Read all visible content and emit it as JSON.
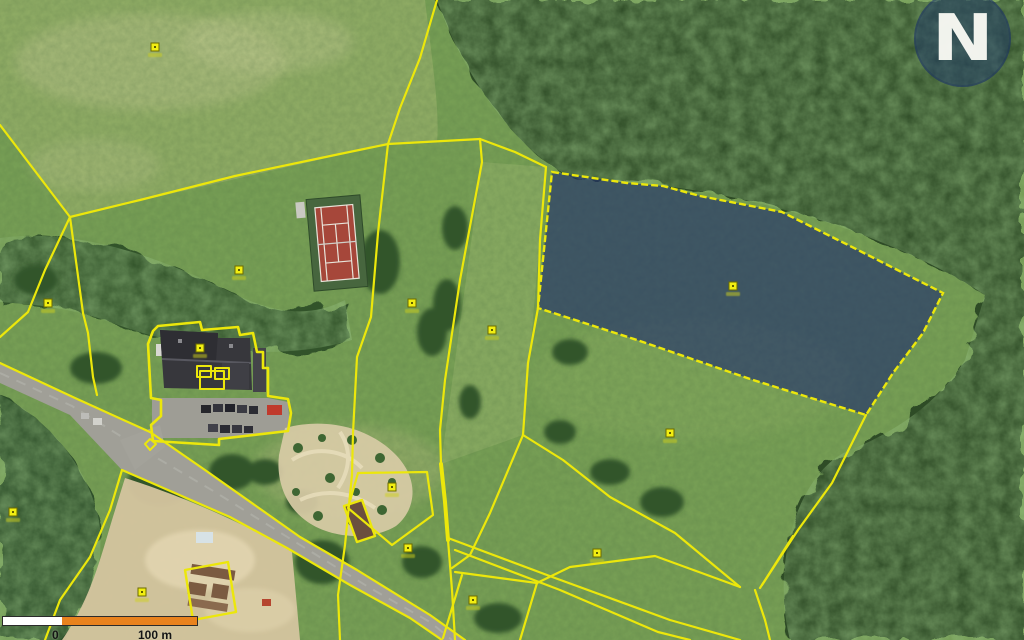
{
  "app": {
    "name": "cadastre-aerial-map-view",
    "logo_letter": "N"
  },
  "scalebar": {
    "label_zero": "0",
    "label_end": "100 m",
    "segment1_color": "#ffffff",
    "segment2_color": "#e8821e"
  },
  "map": {
    "boundary_color": "#ece70b",
    "selected_parcel": {
      "fill": "#18256e",
      "fill_opacity": 0.58,
      "outline_dash": "7 3",
      "points": "552,172 627,183 663,186 700,196 782,212 850,246 943,293 923,333 893,373 866,415 753,380 637,340 538,308 545,240"
    },
    "boundaries": [
      {
        "points": "0,125 70,217"
      },
      {
        "points": "70,217 140,200 235,176 335,155 388,144"
      },
      {
        "points": "437,0 420,58 400,108 388,144"
      },
      {
        "points": "388,144 480,139"
      },
      {
        "points": "480,139 515,152 546,167"
      },
      {
        "points": "388,144 378,233 371,317 357,357 353,433 352,475"
      },
      {
        "points": "352,475 345,545 338,595 340,640"
      },
      {
        "points": "480,139 482,162 460,280 445,380 440,430 441,464"
      },
      {
        "points": "441,464 445,502 448,540",
        "w": 4
      },
      {
        "points": "546,167 540,240 538,308 528,363 523,435"
      },
      {
        "points": "523,435 490,513 470,555 452,568"
      },
      {
        "points": "523,435 563,460 610,497 675,533 740,587"
      },
      {
        "points": "866,415 832,483 798,530 760,588"
      },
      {
        "points": "793,536 762,585"
      },
      {
        "points": "755,590 765,620 770,640"
      },
      {
        "points": "740,587 655,556 570,567 537,583"
      },
      {
        "points": "448,538 555,578 670,620 740,640"
      },
      {
        "points": "455,550 560,590 658,632 690,640"
      },
      {
        "points": "448,540 452,590 455,640"
      },
      {
        "points": "455,572 537,583"
      },
      {
        "points": "537,583 520,640"
      },
      {
        "points": "462,575 443,638"
      },
      {
        "points": "0,363 75,398 150,432 205,470 300,537 357,570 430,615 465,640"
      },
      {
        "points": "122,470 230,517 287,548 350,585 410,618 442,640"
      },
      {
        "points": "122,470 110,510 90,557 60,600 45,640"
      },
      {
        "points": "70,217 83,313 88,333 93,377 97,395"
      },
      {
        "points": "70,217 45,270 28,312 0,337"
      },
      {
        "points": "358,473 427,472 433,515 392,545 348,508",
        "closed": true
      },
      {
        "points": "344,506 362,500 375,536 357,542",
        "closed": true,
        "w": 2.4
      },
      {
        "points": "185,570 228,562 236,612 193,620",
        "closed": true,
        "w": 2.4
      },
      {
        "points": "158,326 200,322 202,330 238,327 240,335 253,333 257,352 263,352 263,368 268,368 268,396 288,399 291,413 288,431 219,439 219,445 153,441 151,425 161,416 161,400 151,398 150,380 148,344 153,331",
        "closed": true,
        "w": 2.6
      },
      {
        "points": "197,366 211,366 211,377 197,377",
        "closed": true,
        "w": 2
      },
      {
        "points": "215,368 229,368 229,379 215,379",
        "closed": true,
        "w": 2
      },
      {
        "points": "200,371 224,371 224,389 200,389",
        "closed": true,
        "w": 2
      },
      {
        "points": "145,444 150,439 156,444 150,450",
        "closed": true,
        "w": 2
      }
    ],
    "parcel_points": [
      [
        155,
        47
      ],
      [
        239,
        270
      ],
      [
        48,
        303
      ],
      [
        412,
        303
      ],
      [
        492,
        330
      ],
      [
        733,
        286
      ],
      [
        670,
        433
      ],
      [
        597,
        553
      ],
      [
        392,
        487
      ],
      [
        408,
        548
      ],
      [
        473,
        600
      ],
      [
        13,
        512
      ],
      [
        200,
        348
      ],
      [
        142,
        592
      ]
    ]
  }
}
